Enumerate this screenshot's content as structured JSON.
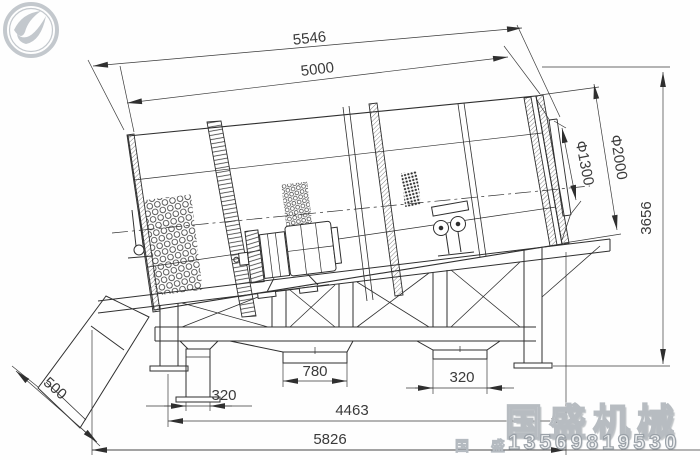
{
  "dims": {
    "top_outer": "5546",
    "top_inner": "5000",
    "outlet_dia": "Φ1300",
    "drum_dia": "Φ2000",
    "height": "3656",
    "chute": "500",
    "left_leg": "320",
    "center_outlet": "780",
    "right_outlet": "320",
    "span": "4463",
    "base": "5826"
  },
  "watermark": {
    "brand": "国盛机械",
    "brand_small": "国 盛",
    "phone": "13569819530"
  },
  "colors": {
    "line": "#2f2f2f",
    "dimension": "#3a3a3a",
    "watermark": "#c3c8cd"
  }
}
